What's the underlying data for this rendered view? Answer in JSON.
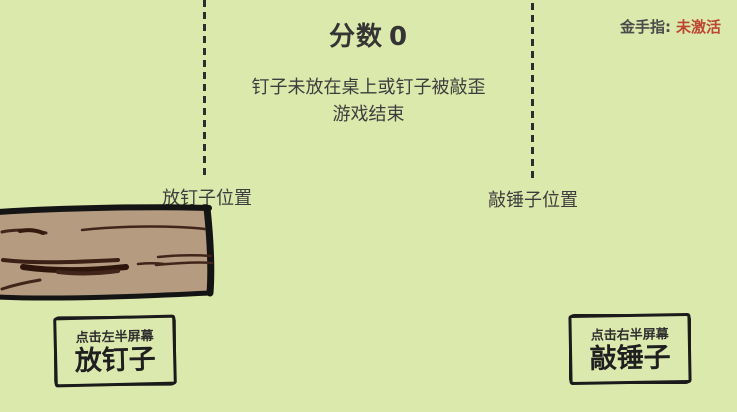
{
  "colors": {
    "background": "#dce9ad",
    "text": "#3d3d3d",
    "outline_black": "#1b1b1b",
    "cheat_inactive_red": "#bb4632",
    "wood_fill": "#b59b80",
    "wood_grain_dark": "#42251a"
  },
  "header": {
    "score_label": "分数",
    "score_value": "0",
    "cheat_label": "金手指:",
    "cheat_status": "未激活"
  },
  "message": {
    "line1": "钉子未放在桌上或钉子被敲歪",
    "line2": "游戏结束"
  },
  "markers": {
    "left_label": "放钉子位置",
    "right_label": "敲锤子位置"
  },
  "buttons": {
    "left": {
      "hint": "点击左半屏幕",
      "label": "放钉子"
    },
    "right": {
      "hint": "点击右半屏幕",
      "label": "敲锤子"
    }
  }
}
